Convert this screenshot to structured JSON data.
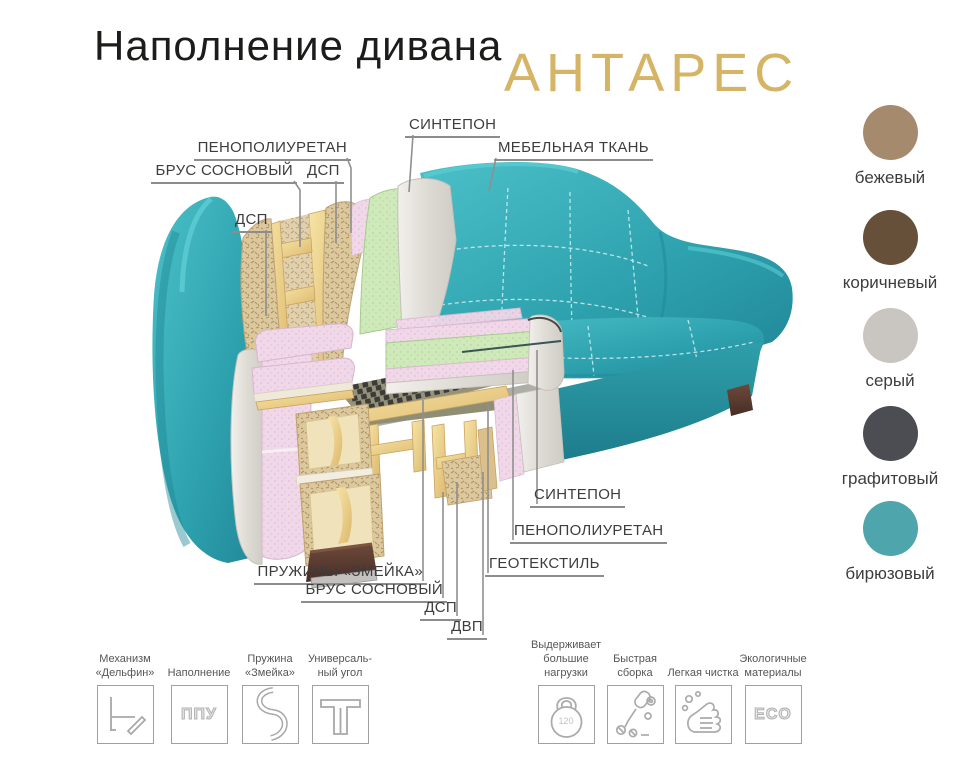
{
  "header": {
    "title": "Наполнение дивана",
    "product_name": "АНТАРЕС",
    "brand_color": "#d5b466"
  },
  "materials": {
    "sintepon_top": "СИНТЕПОН",
    "furniture_fabric": "МЕБЕЛЬНАЯ ТКАНЬ",
    "penopoliuretan_top": "ПЕНОПОЛИУРЕТАН",
    "brus_sosnovy_top": "БРУС СОСНОВЫЙ",
    "dsp_top": "ДСП",
    "dsp_left": "ДСП",
    "sintepon_bottom": "СИНТЕПОН",
    "penopoliuretan_bottom": "ПЕНОПОЛИУРЕТАН",
    "geotextile": "ГЕОТЕКСТИЛЬ",
    "springs_zmeika": "ПРУЖИНЫ «ЗМЕЙКА»",
    "brus_sosnovy_bottom": "БРУС СОСНОВЫЙ",
    "dsp_bottom": "ДСП",
    "dvp_bottom": "ДВП"
  },
  "colors": {
    "swatches": [
      {
        "name": "бежевый",
        "hex": "#a68a6e"
      },
      {
        "name": "коричневый",
        "hex": "#66503a"
      },
      {
        "name": "серый",
        "hex": "#c9c5c0"
      },
      {
        "name": "графитовый",
        "hex": "#4b4d53"
      },
      {
        "name": "бирюзовый",
        "hex": "#4ea5ab"
      }
    ],
    "sofa_fabric": "#33abb6"
  },
  "features": {
    "left": [
      {
        "label": "Механизм\n«Дельфин»",
        "icon": "dolphin-mechanism-icon"
      },
      {
        "label": "Наполнение",
        "icon": "ppu-icon",
        "icon_text": "ППУ"
      },
      {
        "label": "Пружина\n«Змейка»",
        "icon": "snake-spring-icon"
      },
      {
        "label": "Универсаль-\nный угол",
        "icon": "universal-corner-icon"
      }
    ],
    "right": [
      {
        "label": "Выдерживает\nбольшие\nнагрузки",
        "icon": "kettlebell-icon",
        "icon_text": "120"
      },
      {
        "label": "Быстрая\nсборка",
        "icon": "assembly-icon"
      },
      {
        "label": "Легкая чистка",
        "icon": "cleaning-icon"
      },
      {
        "label": "Экологичные\nматериалы",
        "icon": "eco-icon",
        "icon_text": "ECO"
      }
    ]
  }
}
